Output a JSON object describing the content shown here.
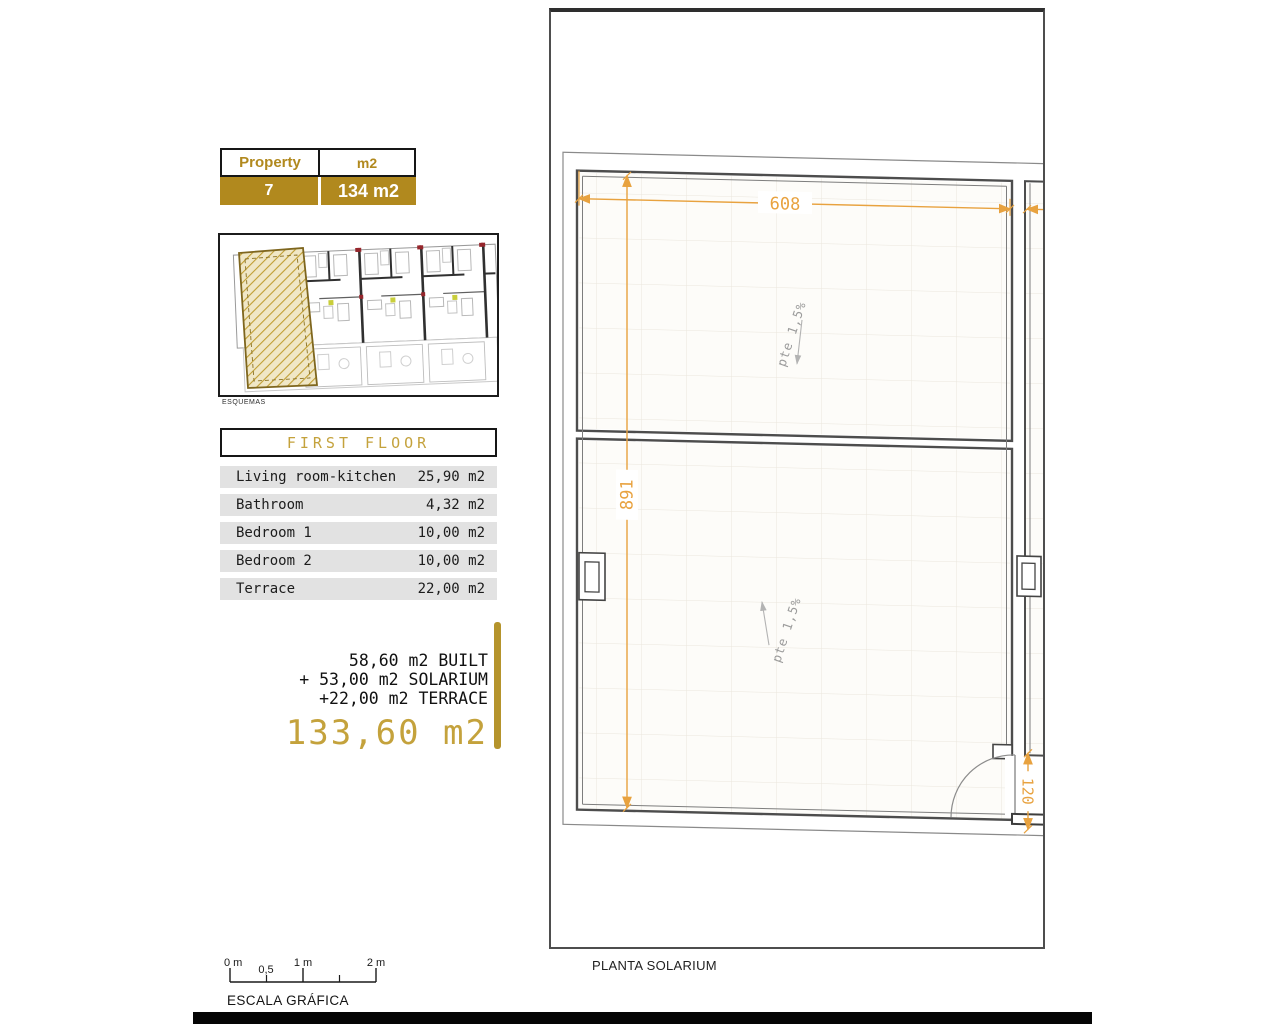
{
  "colors": {
    "gold": "#B1891E",
    "gold-light": "#C4A23C",
    "dimension-orange": "#E8A23F",
    "row-gray": "#E2E2E2"
  },
  "property_table": {
    "col1_header": "Property",
    "col2_header": "m2",
    "property_number": "7",
    "property_size": "134 m2"
  },
  "esquemas": {
    "caption": "ESQUEMAS"
  },
  "first_floor": {
    "title": "FIRST FLOOR",
    "rows": [
      {
        "label": "Living room-kitchen",
        "value": "25,90 m2"
      },
      {
        "label": "Bathroom",
        "value": "4,32 m2"
      },
      {
        "label": "Bedroom 1",
        "value": "10,00 m2"
      },
      {
        "label": "Bedroom 2",
        "value": "10,00 m2"
      },
      {
        "label": "Terrace",
        "value": "22,00 m2"
      }
    ]
  },
  "summary": {
    "line1": "58,60 m2 BUILT",
    "line2": "+ 53,00 m2 SOLARIUM",
    "line3": "+22,00 m2 TERRACE",
    "total": "133,60 m2"
  },
  "scale_bar": {
    "tick0": "0 m",
    "tick05": "0,5",
    "tick1": "1 m",
    "tick2": "2 m",
    "caption": "ESCALA GRÁFICA"
  },
  "plan": {
    "caption": "PLANTA SOLARIUM",
    "dim_width": "608",
    "dim_height": "891",
    "dim_door": "120",
    "slope_note_upper": "pte 1,5%",
    "slope_note_lower": "pte 1,5%"
  }
}
